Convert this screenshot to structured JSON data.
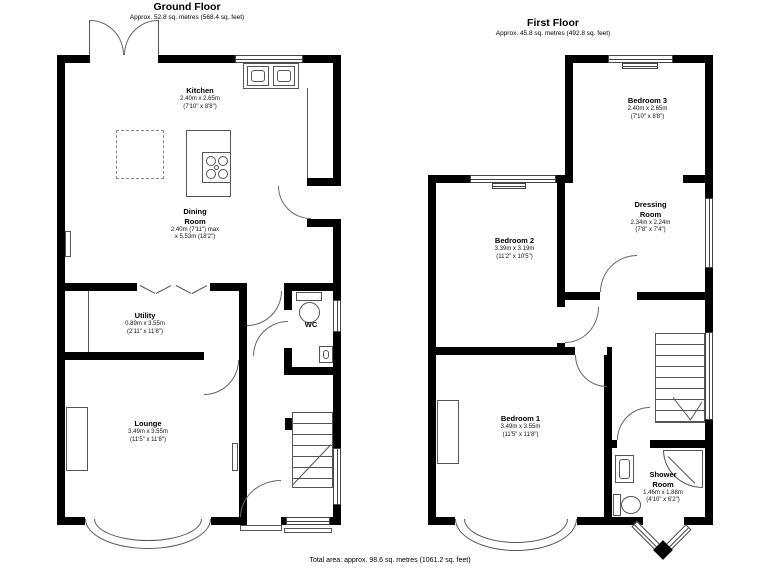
{
  "colors": {
    "wall": "#000000",
    "thin_line": "#555555",
    "text": "#000000"
  },
  "footer": {
    "total_area": "Total area: approx. 98.6 sq. metres (1061.2 sq. feet)"
  },
  "ground_floor": {
    "title": "Ground Floor",
    "subtitle": "Approx. 52.8 sq. metres (568.4 sq. feet)",
    "rooms": {
      "kitchen": {
        "name": "Kitchen",
        "metric": "2.40m x 2.65m",
        "imperial": "(7'10\" x 8'8\")"
      },
      "dining_room": {
        "name": "Dining\nRoom",
        "metric": "2.40m (7'11\") max",
        "imperial": "x 5.53m (18'2\")"
      },
      "utility": {
        "name": "Utility",
        "metric": "0.89m x 3.55m",
        "imperial": "(2'11\" x 11'8\")"
      },
      "wc": {
        "name": "WC"
      },
      "lounge": {
        "name": "Lounge",
        "metric": "3.49m x 3.55m",
        "imperial": "(11'5\" x 11'8\")"
      }
    }
  },
  "first_floor": {
    "title": "First Floor",
    "subtitle": "Approx. 45.8 sq. metres (492.8 sq. feet)",
    "rooms": {
      "bedroom_3": {
        "name": "Bedroom 3",
        "metric": "2.40m x 2.65m",
        "imperial": "(7'10\" x 8'8\")"
      },
      "dressing_room": {
        "name": "Dressing\nRoom",
        "metric": "2.34m x 2.24m",
        "imperial": "(7'8\" x 7'4\")"
      },
      "bedroom_2": {
        "name": "Bedroom 2",
        "metric": "3.39m x 3.19m",
        "imperial": "(11'2\" x 10'5\")"
      },
      "bedroom_1": {
        "name": "Bedroom 1",
        "metric": "3.49m x 3.55m",
        "imperial": "(11'5\" x 11'8\")"
      },
      "shower_room": {
        "name": "Shower\nRoom",
        "metric": "1.46m x 1.88m",
        "imperial": "(4'10\" x 6'2\")"
      }
    }
  }
}
